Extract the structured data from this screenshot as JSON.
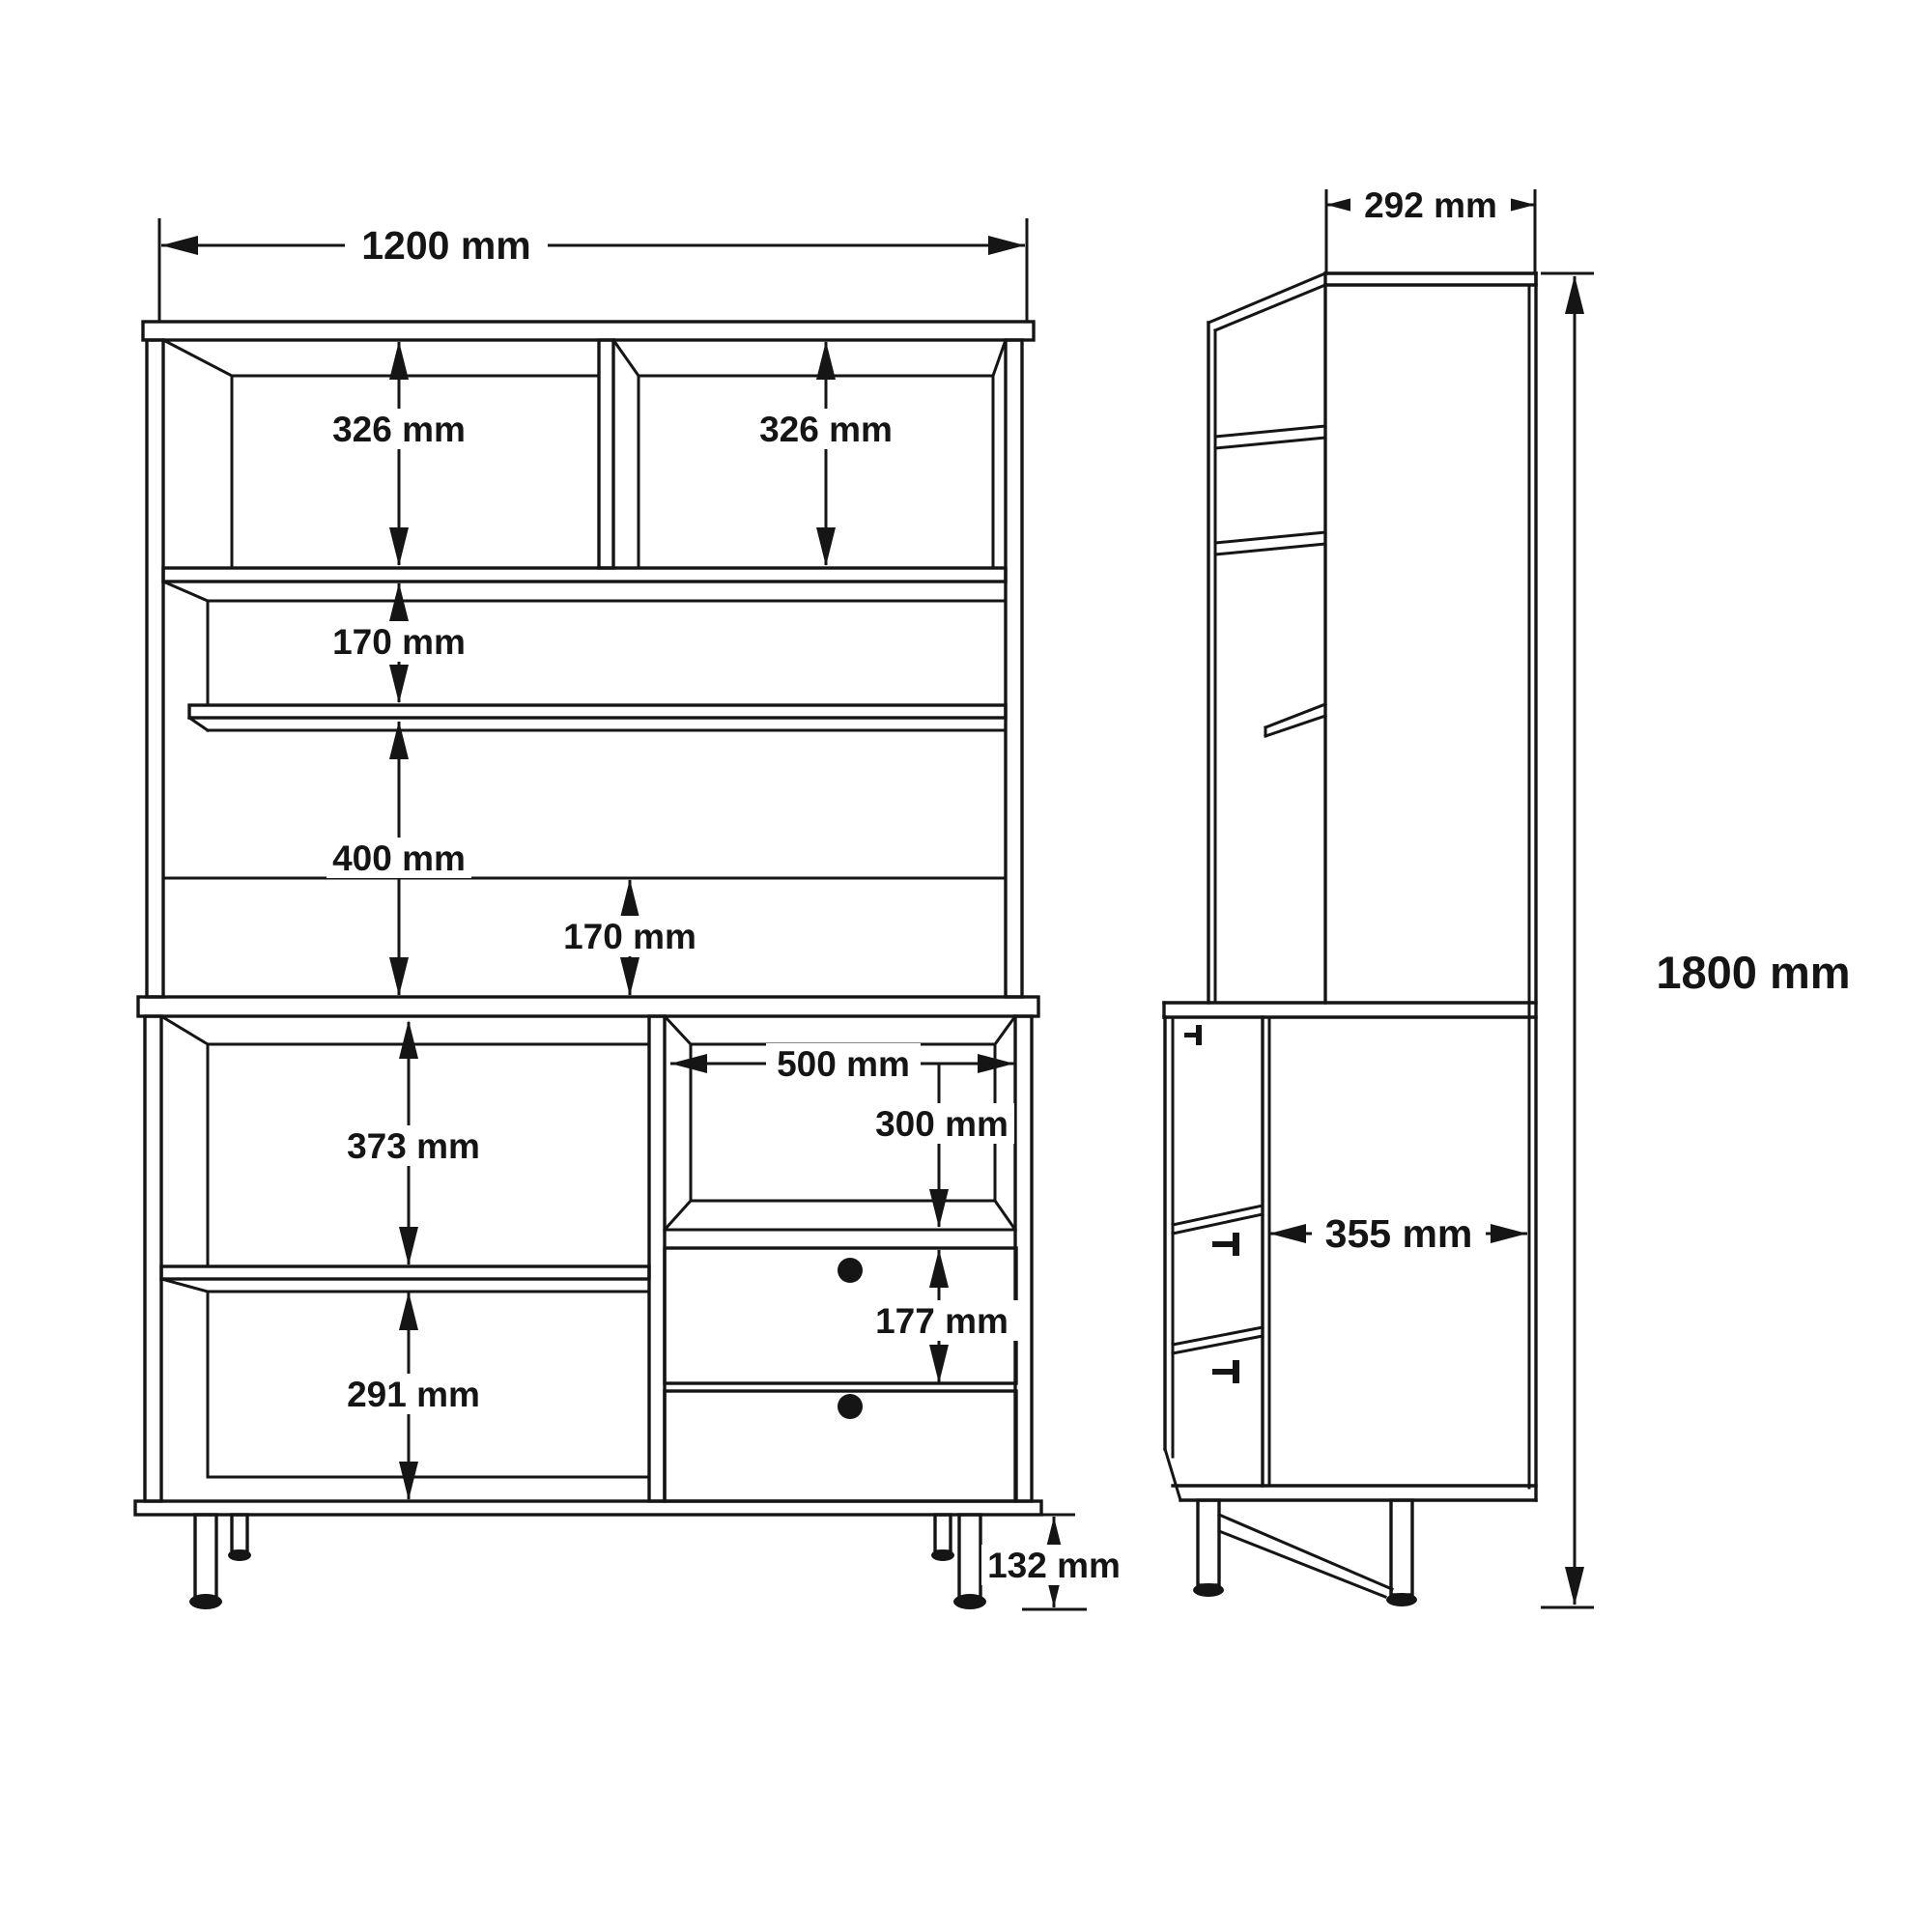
{
  "dims": {
    "overall_width": "1200 mm",
    "top_left_shelf_height": "326 mm",
    "top_right_shelf_height": "326 mm",
    "upper_gap_height": "170 mm",
    "middle_opening_height": "400 mm",
    "counter_gap_height": "170 mm",
    "niche_width": "500 mm",
    "niche_height": "300 mm",
    "lower_left_upper_height": "373 mm",
    "drawer_height": "177 mm",
    "lower_left_bottom_height": "291 mm",
    "leg_height": "132 mm",
    "upper_depth": "292 mm",
    "lower_depth": "355 mm",
    "overall_height": "1800 mm"
  }
}
